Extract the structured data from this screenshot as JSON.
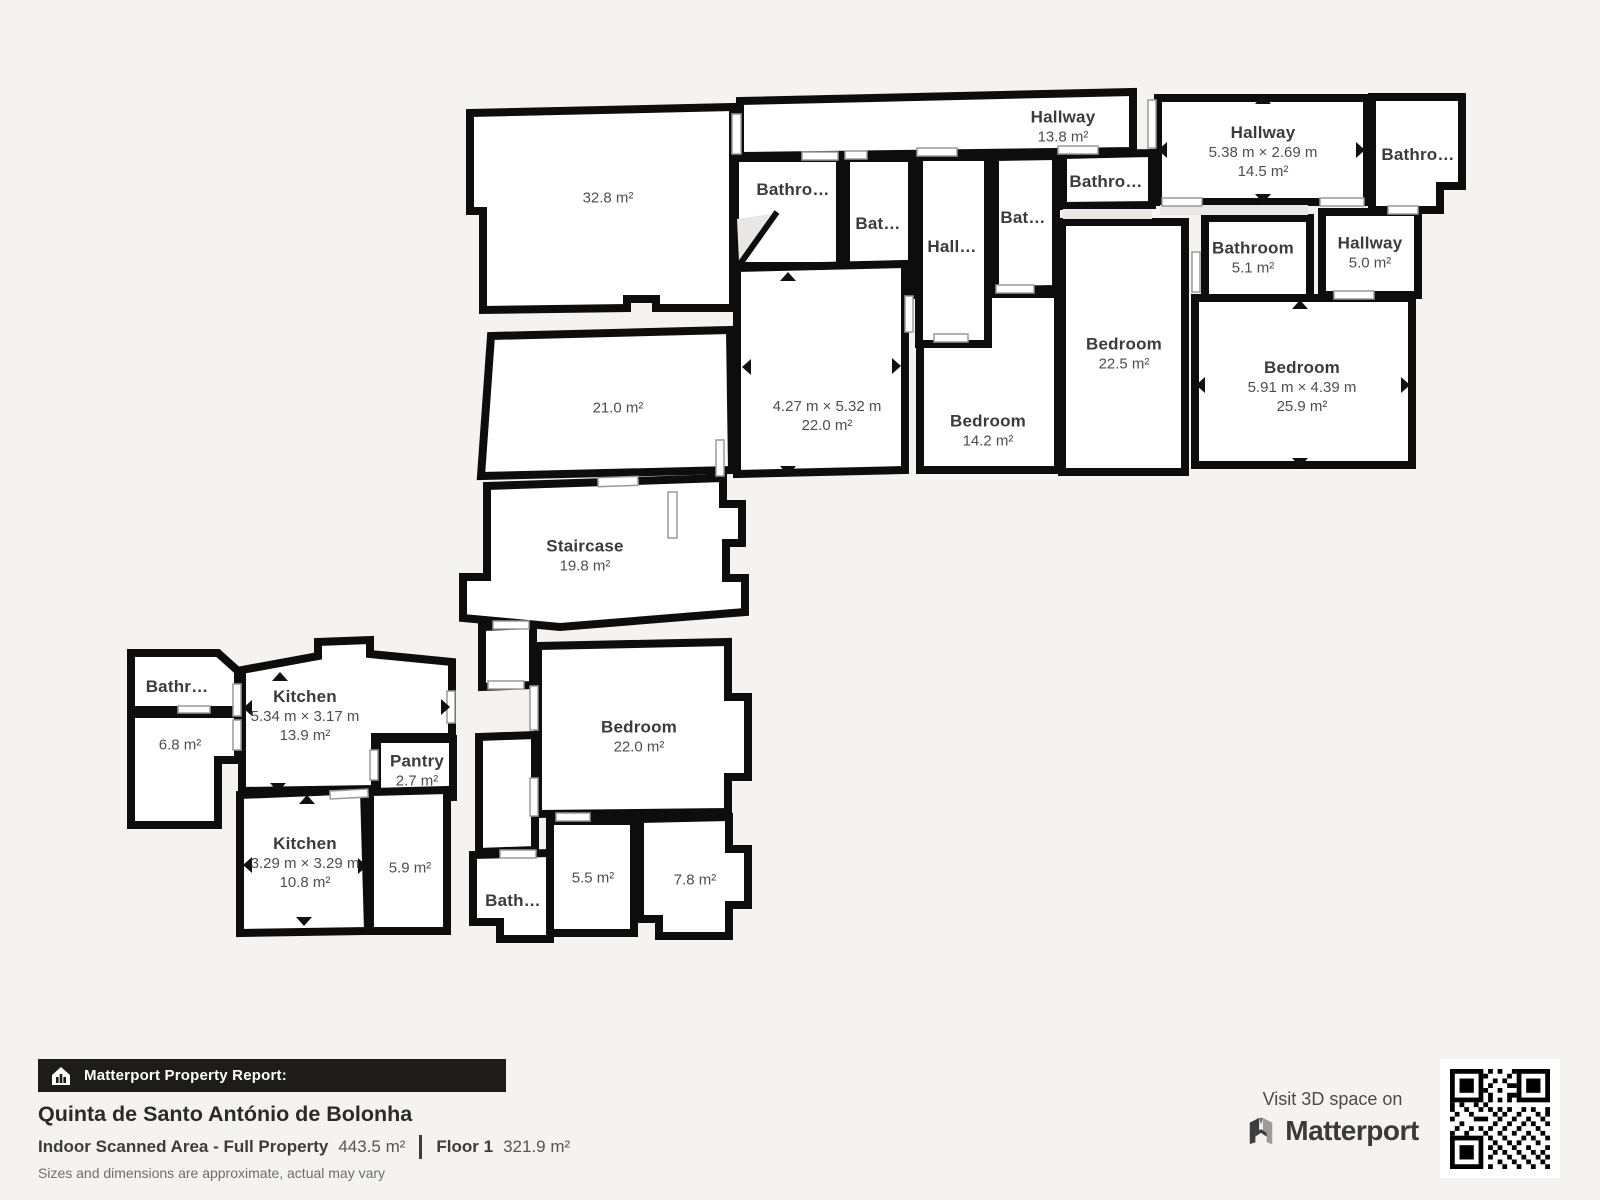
{
  "page": {
    "background": "#f4f3f1",
    "wall_color": "#0d0d0d",
    "room_fill": "#ffffff",
    "label_color": "#3b3b3b"
  },
  "plan": {
    "rooms": {
      "hallTop": {
        "name": "Hallway",
        "area": "13.8 m²"
      },
      "hallRight": {
        "name": "Hallway",
        "dims": "5.38 m × 2.69 m",
        "area": "14.5 m²"
      },
      "bathTopRight": {
        "name": "Bathro…"
      },
      "bathA": {
        "name": "Bathro…"
      },
      "bathB": {
        "name": "Bat…"
      },
      "hallC": {
        "name": "Hall…"
      },
      "bathD": {
        "name": "Bat…"
      },
      "bathE": {
        "name": "Bathro…"
      },
      "bathroom51": {
        "name": "Bathroom",
        "area": "5.1 m²"
      },
      "hallway50": {
        "name": "Hallway",
        "area": "5.0 m²"
      },
      "bedroom225": {
        "name": "Bedroom",
        "area": "22.5 m²"
      },
      "bedroom259": {
        "name": "Bedroom",
        "dims": "5.91 m × 4.39 m",
        "area": "25.9 m²"
      },
      "room220a": {
        "dims": "4.27 m × 5.32 m",
        "area": "22.0 m²"
      },
      "bedroom142": {
        "name": "Bedroom",
        "area": "14.2 m²"
      },
      "room328": {
        "area": "32.8 m²"
      },
      "room210": {
        "area": "21.0 m²"
      },
      "staircase": {
        "name": "Staircase",
        "area": "19.8 m²"
      },
      "bathLeft": {
        "name": "Bathr…"
      },
      "room68": {
        "area": "6.8 m²"
      },
      "kitchen139": {
        "name": "Kitchen",
        "dims": "5.34 m × 3.17 m",
        "area": "13.9 m²"
      },
      "pantry": {
        "name": "Pantry",
        "area": "2.7 m²"
      },
      "bedroom220": {
        "name": "Bedroom",
        "area": "22.0 m²"
      },
      "kitchen108": {
        "name": "Kitchen",
        "dims": "3.29 m × 3.29 m",
        "area": "10.8 m²"
      },
      "room59": {
        "area": "5.9 m²"
      },
      "bathF": {
        "name": "Bath…"
      },
      "room55": {
        "area": "5.5 m²"
      },
      "room78": {
        "area": "7.8 m²"
      }
    }
  },
  "footer": {
    "report_label": "Matterport Property Report:",
    "property_title": "Quinta de Santo António de Bolonha",
    "scanned_area_label": "Indoor Scanned Area - Full Property",
    "scanned_area_value": "443.5 m²",
    "floor_label": "Floor 1",
    "floor_value": "321.9 m²",
    "disclaimer": "Sizes and dimensions are approximate, actual may vary"
  },
  "promo": {
    "visit_text": "Visit 3D space on",
    "brand": "Matterport"
  }
}
